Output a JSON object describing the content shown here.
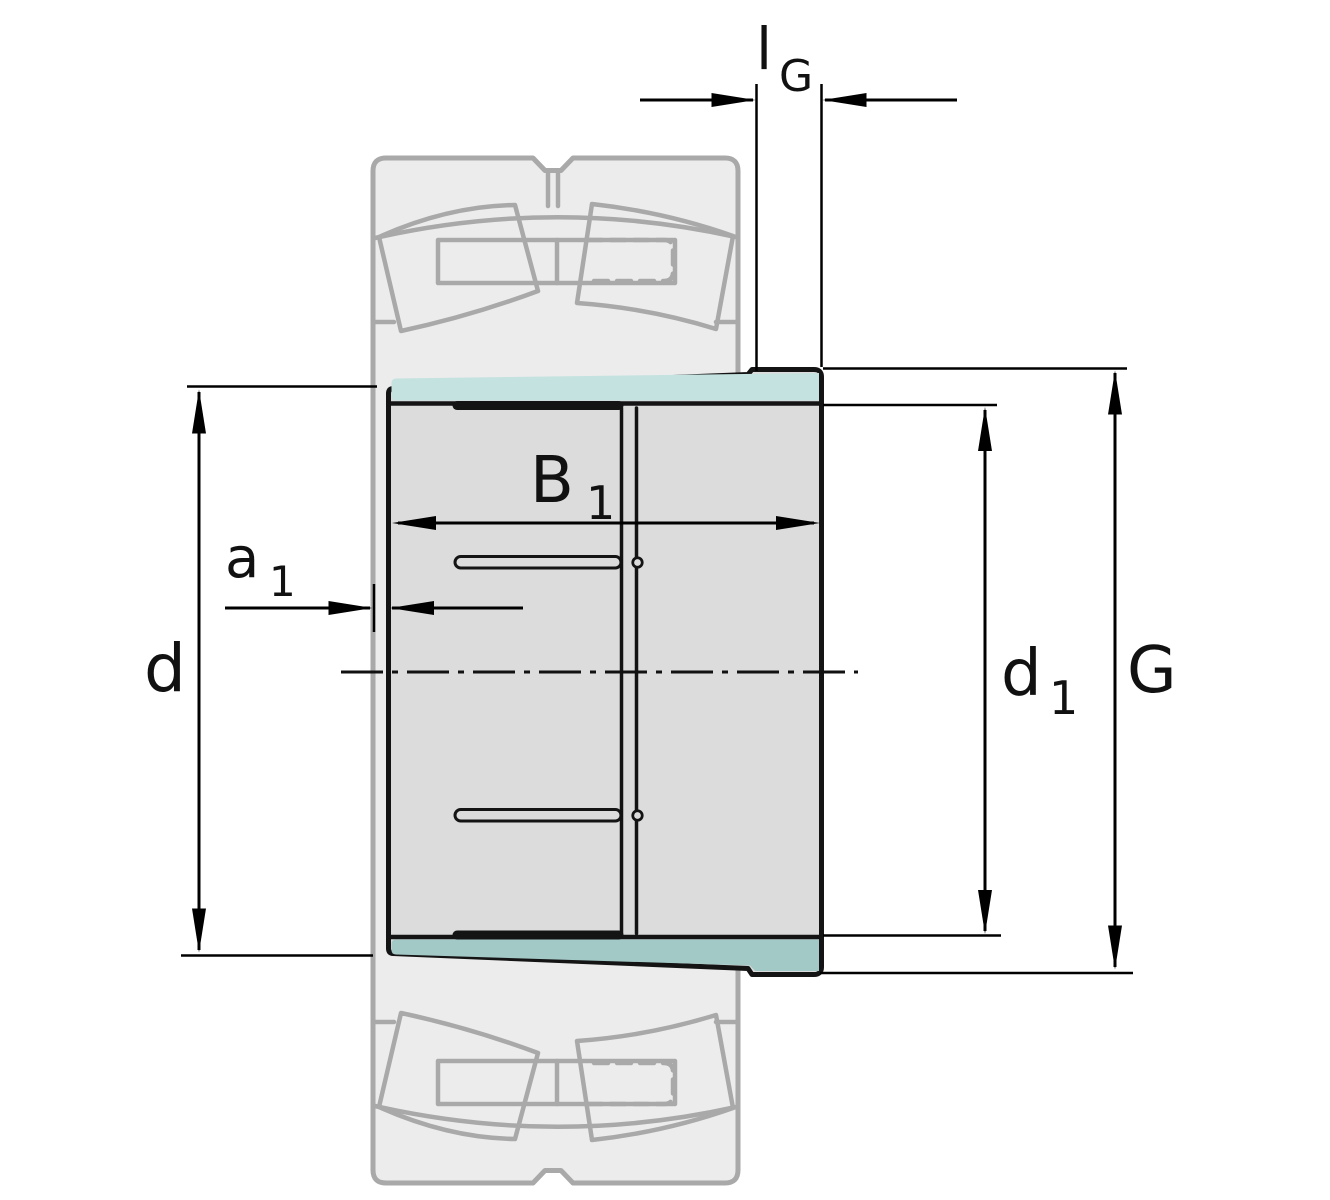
{
  "diagram": {
    "title": "adapter-sleeve-with-spherical-roller-bearing-dimension-drawing",
    "labels": {
      "thread_length": {
        "base": "l",
        "sub": "G"
      },
      "sleeve_width": {
        "base": "B",
        "sub": "1"
      },
      "protrusion": {
        "base": "a",
        "sub": "1"
      },
      "bore_diameter": {
        "base": "d",
        "sub": ""
      },
      "large_bore_diameter": {
        "base": "d",
        "sub": "1"
      },
      "thread_diameter": {
        "base": "G",
        "sub": ""
      }
    },
    "colors": {
      "background": "#ffffff",
      "sleeve_fill": "#dcdcdc",
      "sleeve_outline": "#141414",
      "taper_surface_top": "#c4e2df",
      "taper_surface_bottom": "#a3c9c7",
      "ghost_fill": "#ececec",
      "ghost_stroke": "#a9a9a9",
      "dimension_lines": "#000000"
    }
  }
}
